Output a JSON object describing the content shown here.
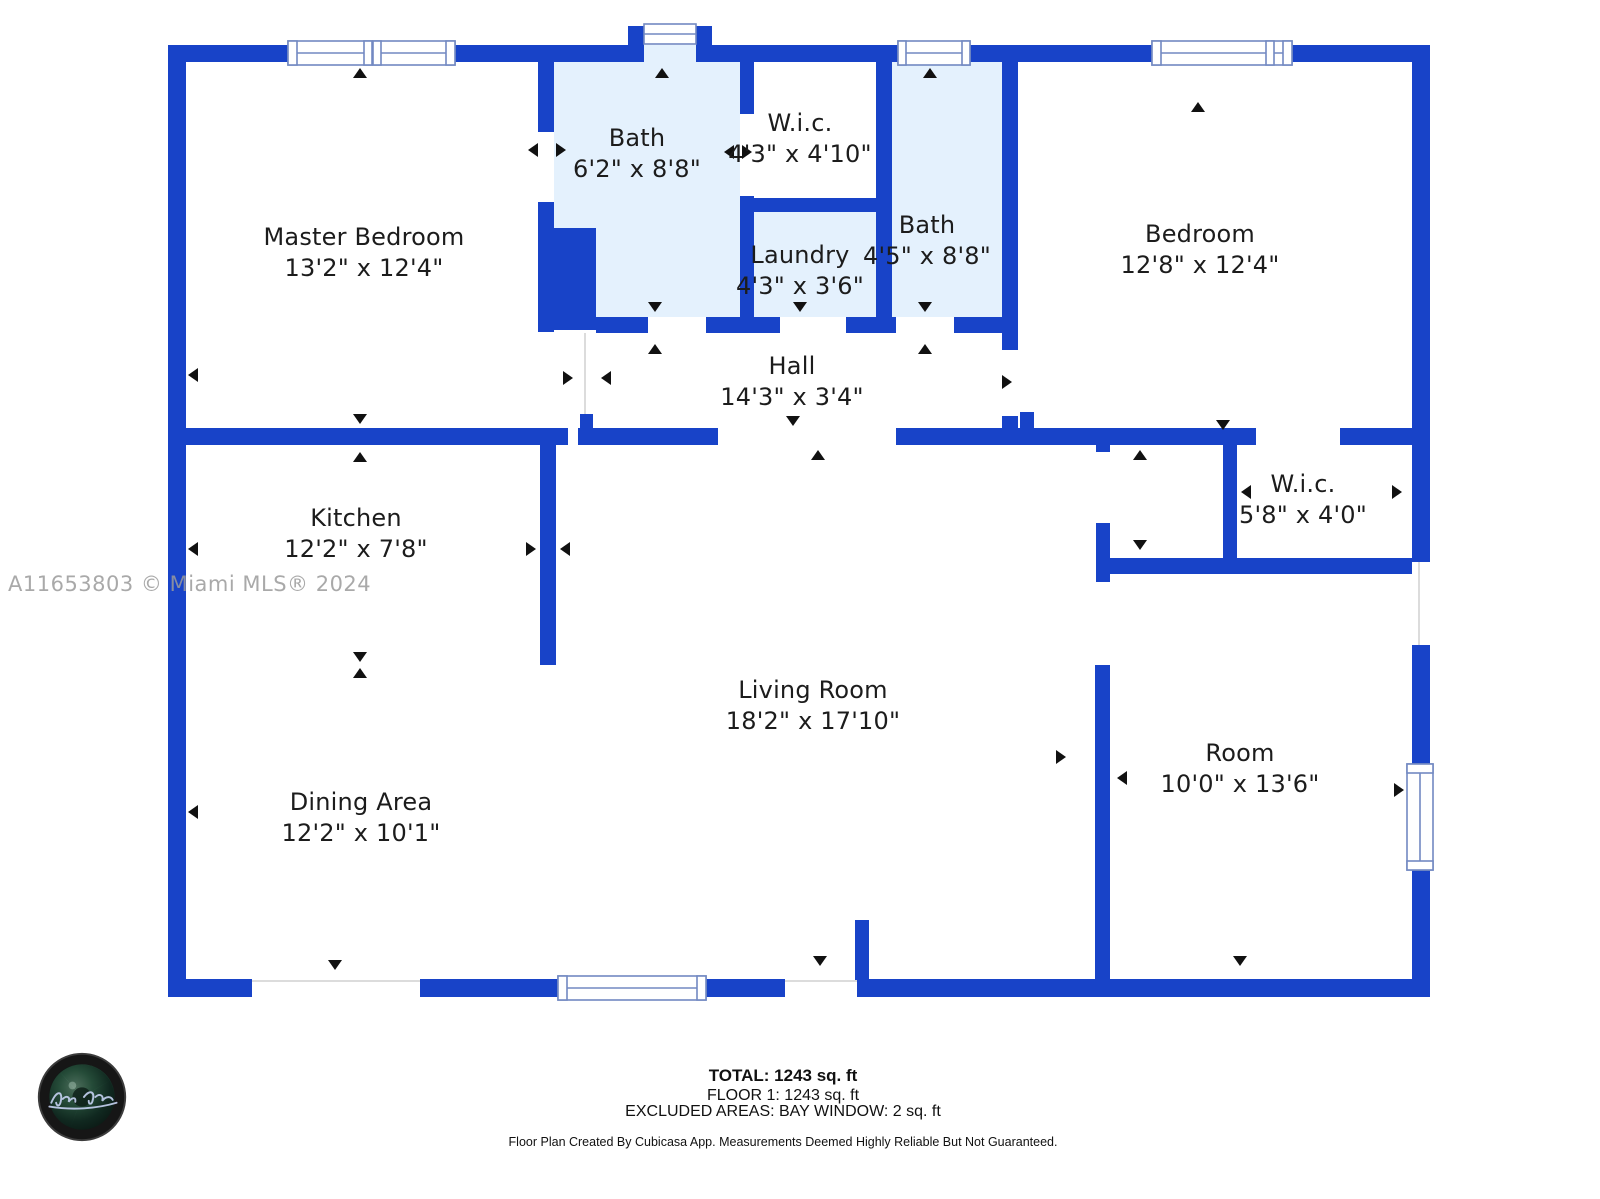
{
  "plan": {
    "rooms": [
      {
        "name": "Master Bedroom",
        "dims": "13'2\" x 12'4\""
      },
      {
        "name": "Bath",
        "dims": "6'2\" x 8'8\""
      },
      {
        "name": "W.i.c.",
        "dims": "4'3\" x 4'10\""
      },
      {
        "name": "Laundry",
        "dims": "4'3\" x 3'6\""
      },
      {
        "name": "Bath",
        "dims": "4'5\" x 8'8\""
      },
      {
        "name": "Bedroom",
        "dims": "12'8\" x 12'4\""
      },
      {
        "name": "Hall",
        "dims": "14'3\" x 3'4\""
      },
      {
        "name": "Kitchen",
        "dims": "12'2\" x 7'8\""
      },
      {
        "name": "W.i.c.",
        "dims": "5'8\" x 4'0\""
      },
      {
        "name": "Living Room",
        "dims": "18'2\" x 17'10\""
      },
      {
        "name": "Dining Area",
        "dims": "12'2\" x 10'1\""
      },
      {
        "name": "Room",
        "dims": "10'0\" x 13'6\""
      }
    ],
    "watermark": "A11653803 © Miami MLS® 2024"
  },
  "footer": {
    "total": "TOTAL: 1243 sq. ft",
    "floor": "FLOOR 1: 1243 sq. ft",
    "excluded": "EXCLUDED AREAS: BAY WINDOW: 2 sq. ft",
    "disclaimer": "Floor Plan Created By Cubicasa App. Measurements Deemed Highly Reliable But Not Guaranteed."
  },
  "colors": {
    "wall": "#1843C8",
    "room_highlight": "#E4F1FD",
    "window_frame": "#7289C2",
    "text": "#1C1C1C",
    "watermark": "#9B9B9B"
  }
}
